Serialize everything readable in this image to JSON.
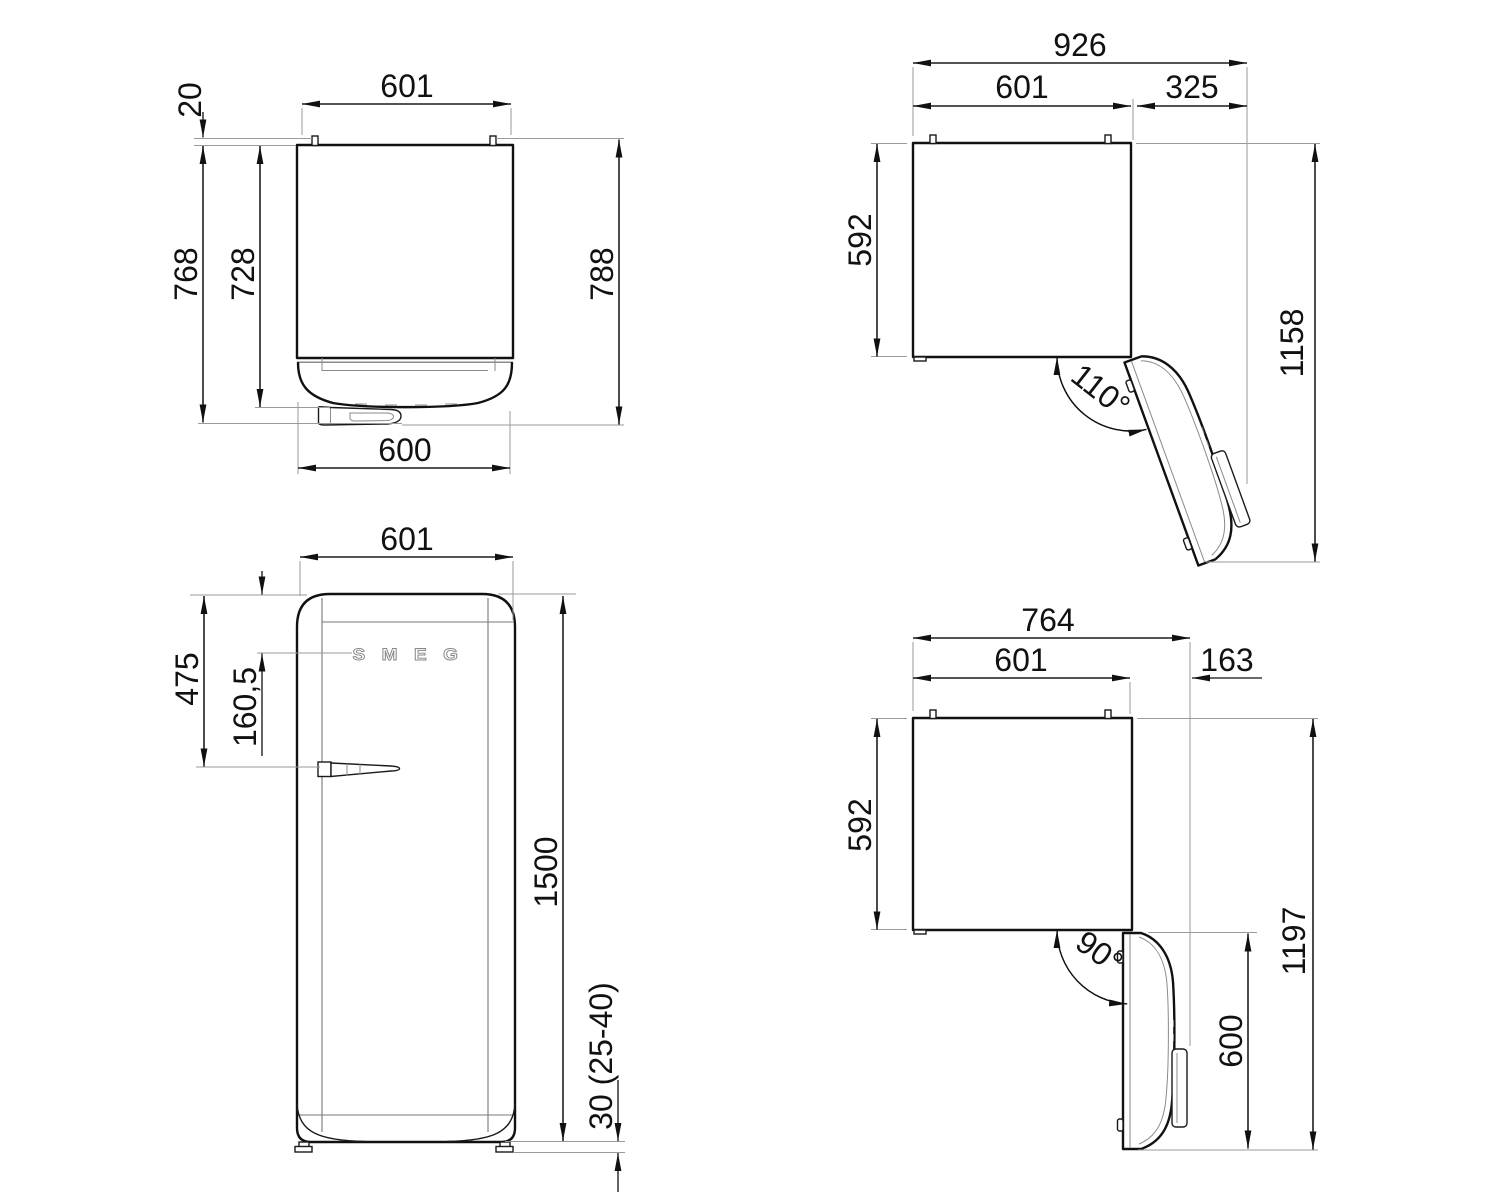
{
  "views": {
    "top_closed": {
      "width_top": "601",
      "hinge_gap": "20",
      "depth_with_handle": "768",
      "body_depth": "728",
      "total_depth": "788",
      "door_width": "600"
    },
    "top_open_110": {
      "total_width": "926",
      "cabinet_width": "601",
      "side_clearance": "325",
      "cabinet_depth": "592",
      "open_depth": "1158",
      "door_angle": "110°"
    },
    "front": {
      "width": "601",
      "top_to_handle": "475",
      "top_to_logo": "160,5",
      "height": "1500",
      "feet_height": "30 (25-40)",
      "logo": "S M E G"
    },
    "top_open_90": {
      "total_width": "764",
      "cabinet_width": "601",
      "side_clearance": "163",
      "cabinet_depth": "592",
      "open_depth": "1197",
      "door_angle": "90°",
      "door_width": "600"
    }
  }
}
